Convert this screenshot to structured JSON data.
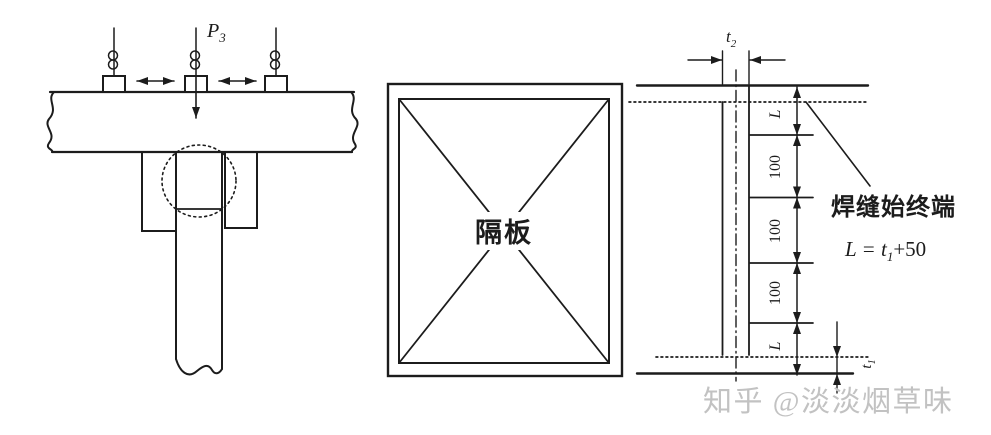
{
  "colors": {
    "ink": "#1c1c1c",
    "watermark": "#c2c2c2"
  },
  "left_diagram": {
    "load_label": {
      "main": "P",
      "sub": "3"
    }
  },
  "middle_diagram": {
    "plate_label": "隔板"
  },
  "right_diagram": {
    "top_thickness_label": {
      "main": "t",
      "sub": "2"
    },
    "dim_labels": [
      "L",
      "100",
      "100",
      "100",
      "L"
    ],
    "weld_note": "焊缝始终端",
    "formula": {
      "lhs": "L = t",
      "sub": "1",
      "rhs": "+50"
    },
    "bottom_thickness_label": {
      "main": "t",
      "sub": "1"
    }
  },
  "watermark": {
    "text": "知乎 @淡淡烟草味"
  }
}
